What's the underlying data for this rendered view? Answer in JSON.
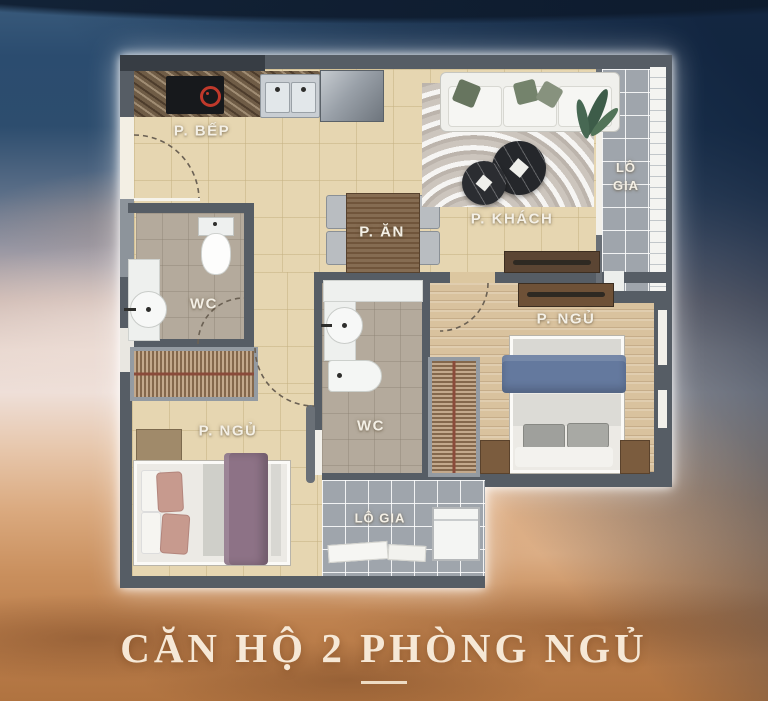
{
  "poster": {
    "title": "CĂN HỘ 2 PHÒNG NGỦ"
  },
  "floorplan": {
    "rooms": {
      "kitchen": {
        "label": "P. BẾP"
      },
      "dining": {
        "label": "P. ĂN"
      },
      "living": {
        "label": "P. KHÁCH"
      },
      "loggia_right": {
        "label_line1": "LÔ",
        "label_line2": "GIA"
      },
      "wc1": {
        "label": "WC"
      },
      "wc2": {
        "label": "WC"
      },
      "bedroom_master": {
        "label": "P. NGỦ"
      },
      "bedroom_second": {
        "label": "P. NGỦ"
      },
      "loggia_bottom": {
        "label": "LÔ GIA"
      }
    },
    "colors": {
      "wall": "#565d65",
      "floor_tile": "#e6d6b1",
      "floor_wood": "#d9c29e",
      "floor_wc": "#b4aa9c",
      "floor_loggia": "#9fa5ac",
      "blanket_blue": "#64799e",
      "blanket_purple": "#8d7286",
      "title_cream": "#f6e8d6"
    }
  },
  "sky": {
    "top": "#2b4c6f",
    "middle": "#eedfd8",
    "bottom": "#b07340"
  }
}
